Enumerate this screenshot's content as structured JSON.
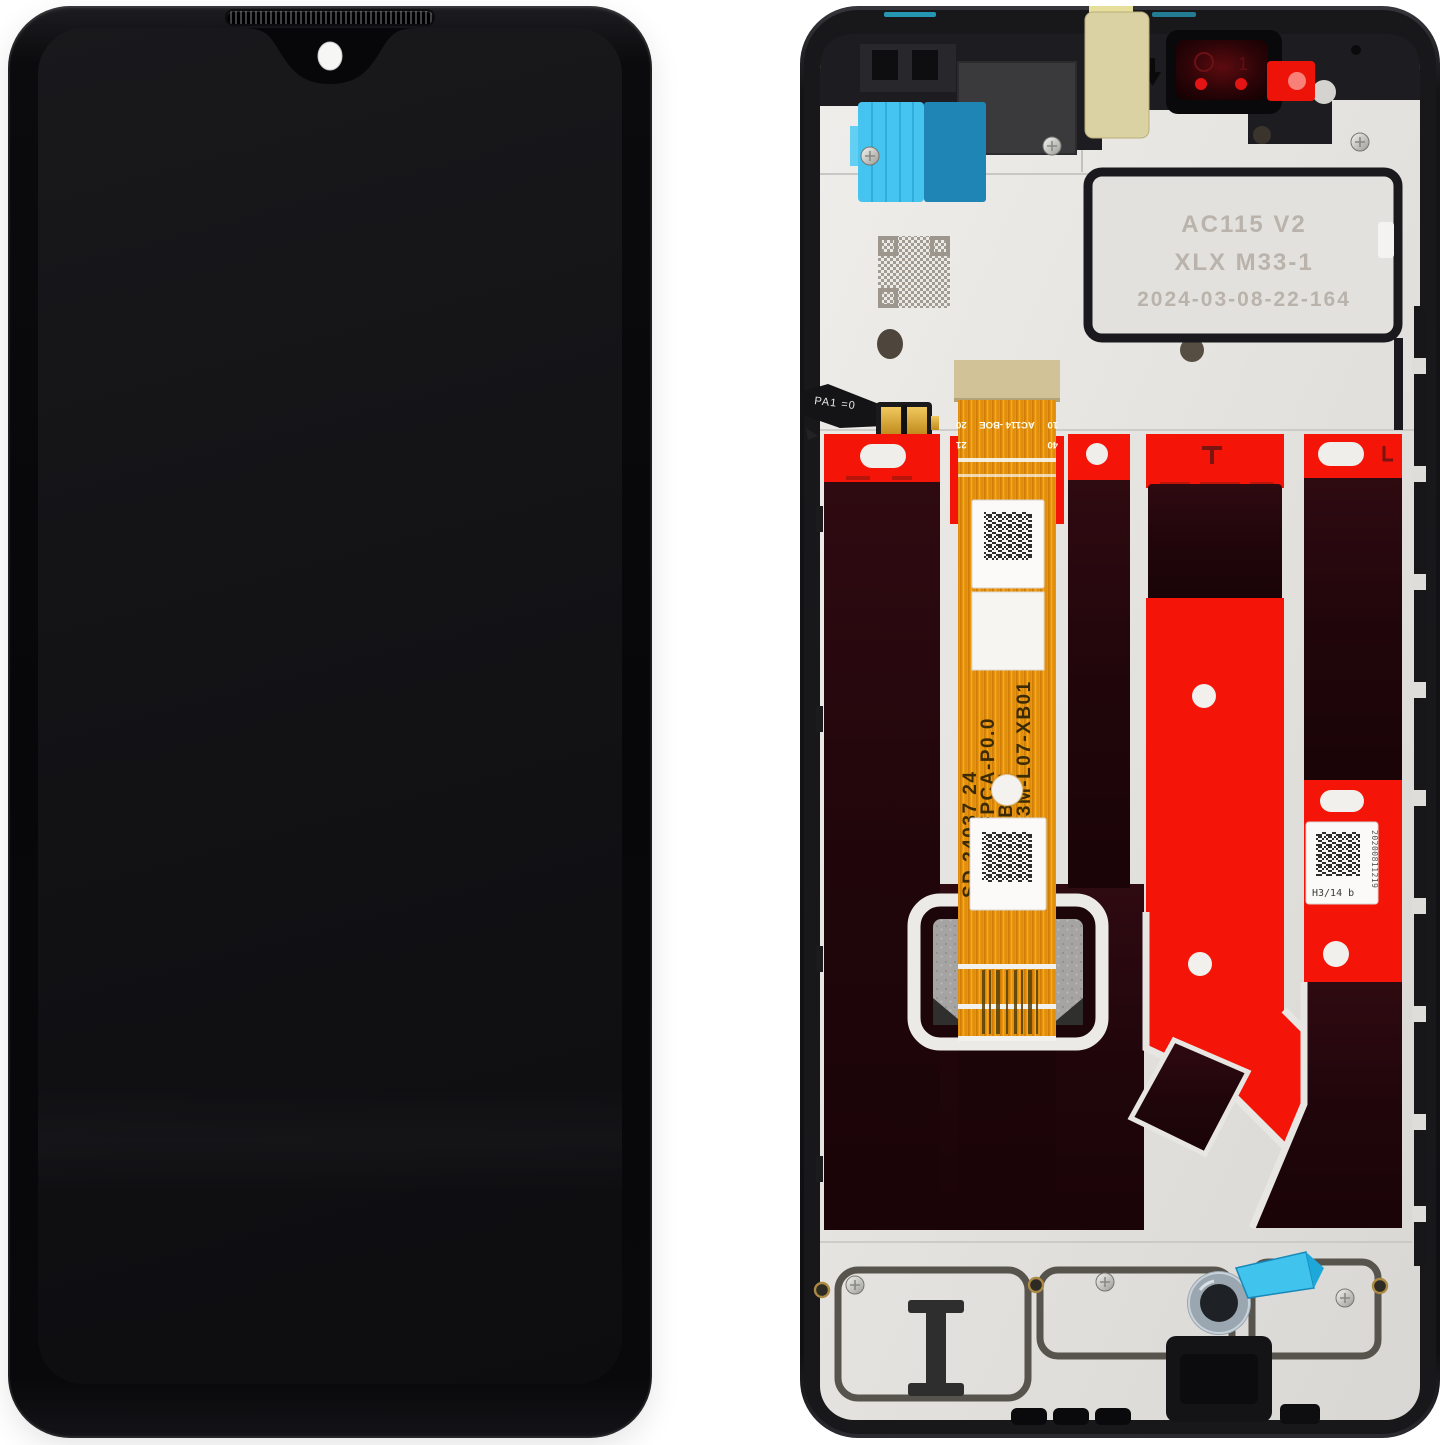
{
  "back": {
    "plate_etch": {
      "line1": "AC115 V2",
      "line2": "XLX M33-1",
      "line3": "2024-03-08-22-164"
    },
    "main_flex": {
      "pin_top_left": "20",
      "pin_top_right": "10",
      "pin_center": "AC114 -BOE",
      "pin_bottom_left": "21",
      "pin_bottom_right": "40",
      "vertical_col1": "SD 24037 24",
      "vertical_col2": "P6600-FPCA-P0.0",
      "vertical_col3": "AC114 -BOE",
      "vertical_col4": "BV066G3M-L07-XB01"
    },
    "small_flex_marking": "PA1 =0",
    "camera_mark": "1",
    "serial_label": {
      "code": "H3/14 b",
      "serial": "20200811219"
    }
  },
  "colors": {
    "adhesive_red": "#f51408",
    "flex_orange": "#e8950f",
    "tape_blue_light": "#45c4ef",
    "tape_blue_dark": "#1f85b5",
    "sticker_khaki": "#dbd2a4",
    "sticker_red": "#ed1309",
    "plate_silver": "#e6e4e0",
    "frame_black": "#18181b",
    "panel_maroon": "#22070c"
  }
}
